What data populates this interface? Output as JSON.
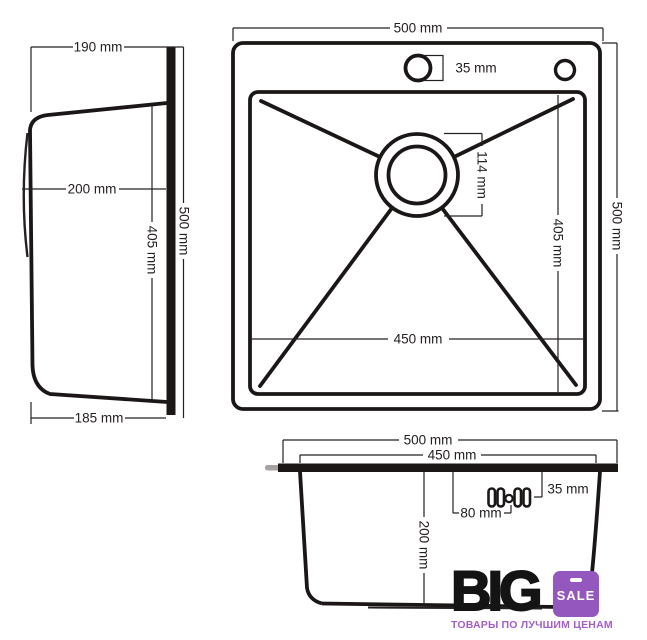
{
  "colors": {
    "line": "#262020",
    "badge": "#9457bd",
    "tagline": "#a25fc6"
  },
  "side_view": {
    "width_top": "190 mm",
    "depth_to_drain": "200 mm",
    "bowl_length": "405 mm",
    "total_length": "500 mm",
    "width_bottom": "185 mm"
  },
  "top_view": {
    "total_width": "500 mm",
    "faucet_hole_diameter": "35 mm",
    "drain_diameter": "114 mm",
    "bowl_depth": "405 mm",
    "total_depth": "500 mm",
    "bowl_width": "450 mm"
  },
  "front_view": {
    "total_width": "500 mm",
    "bowl_width": "450 mm",
    "clip_offset": "35 mm",
    "clip_spacing": "80 mm",
    "bowl_height": "200 mm"
  },
  "logo": {
    "brand": "BIG",
    "badge": "SALE",
    "tagline": "ТОВАРЫ ПО ЛУЧШИМ ЦЕНАМ"
  }
}
